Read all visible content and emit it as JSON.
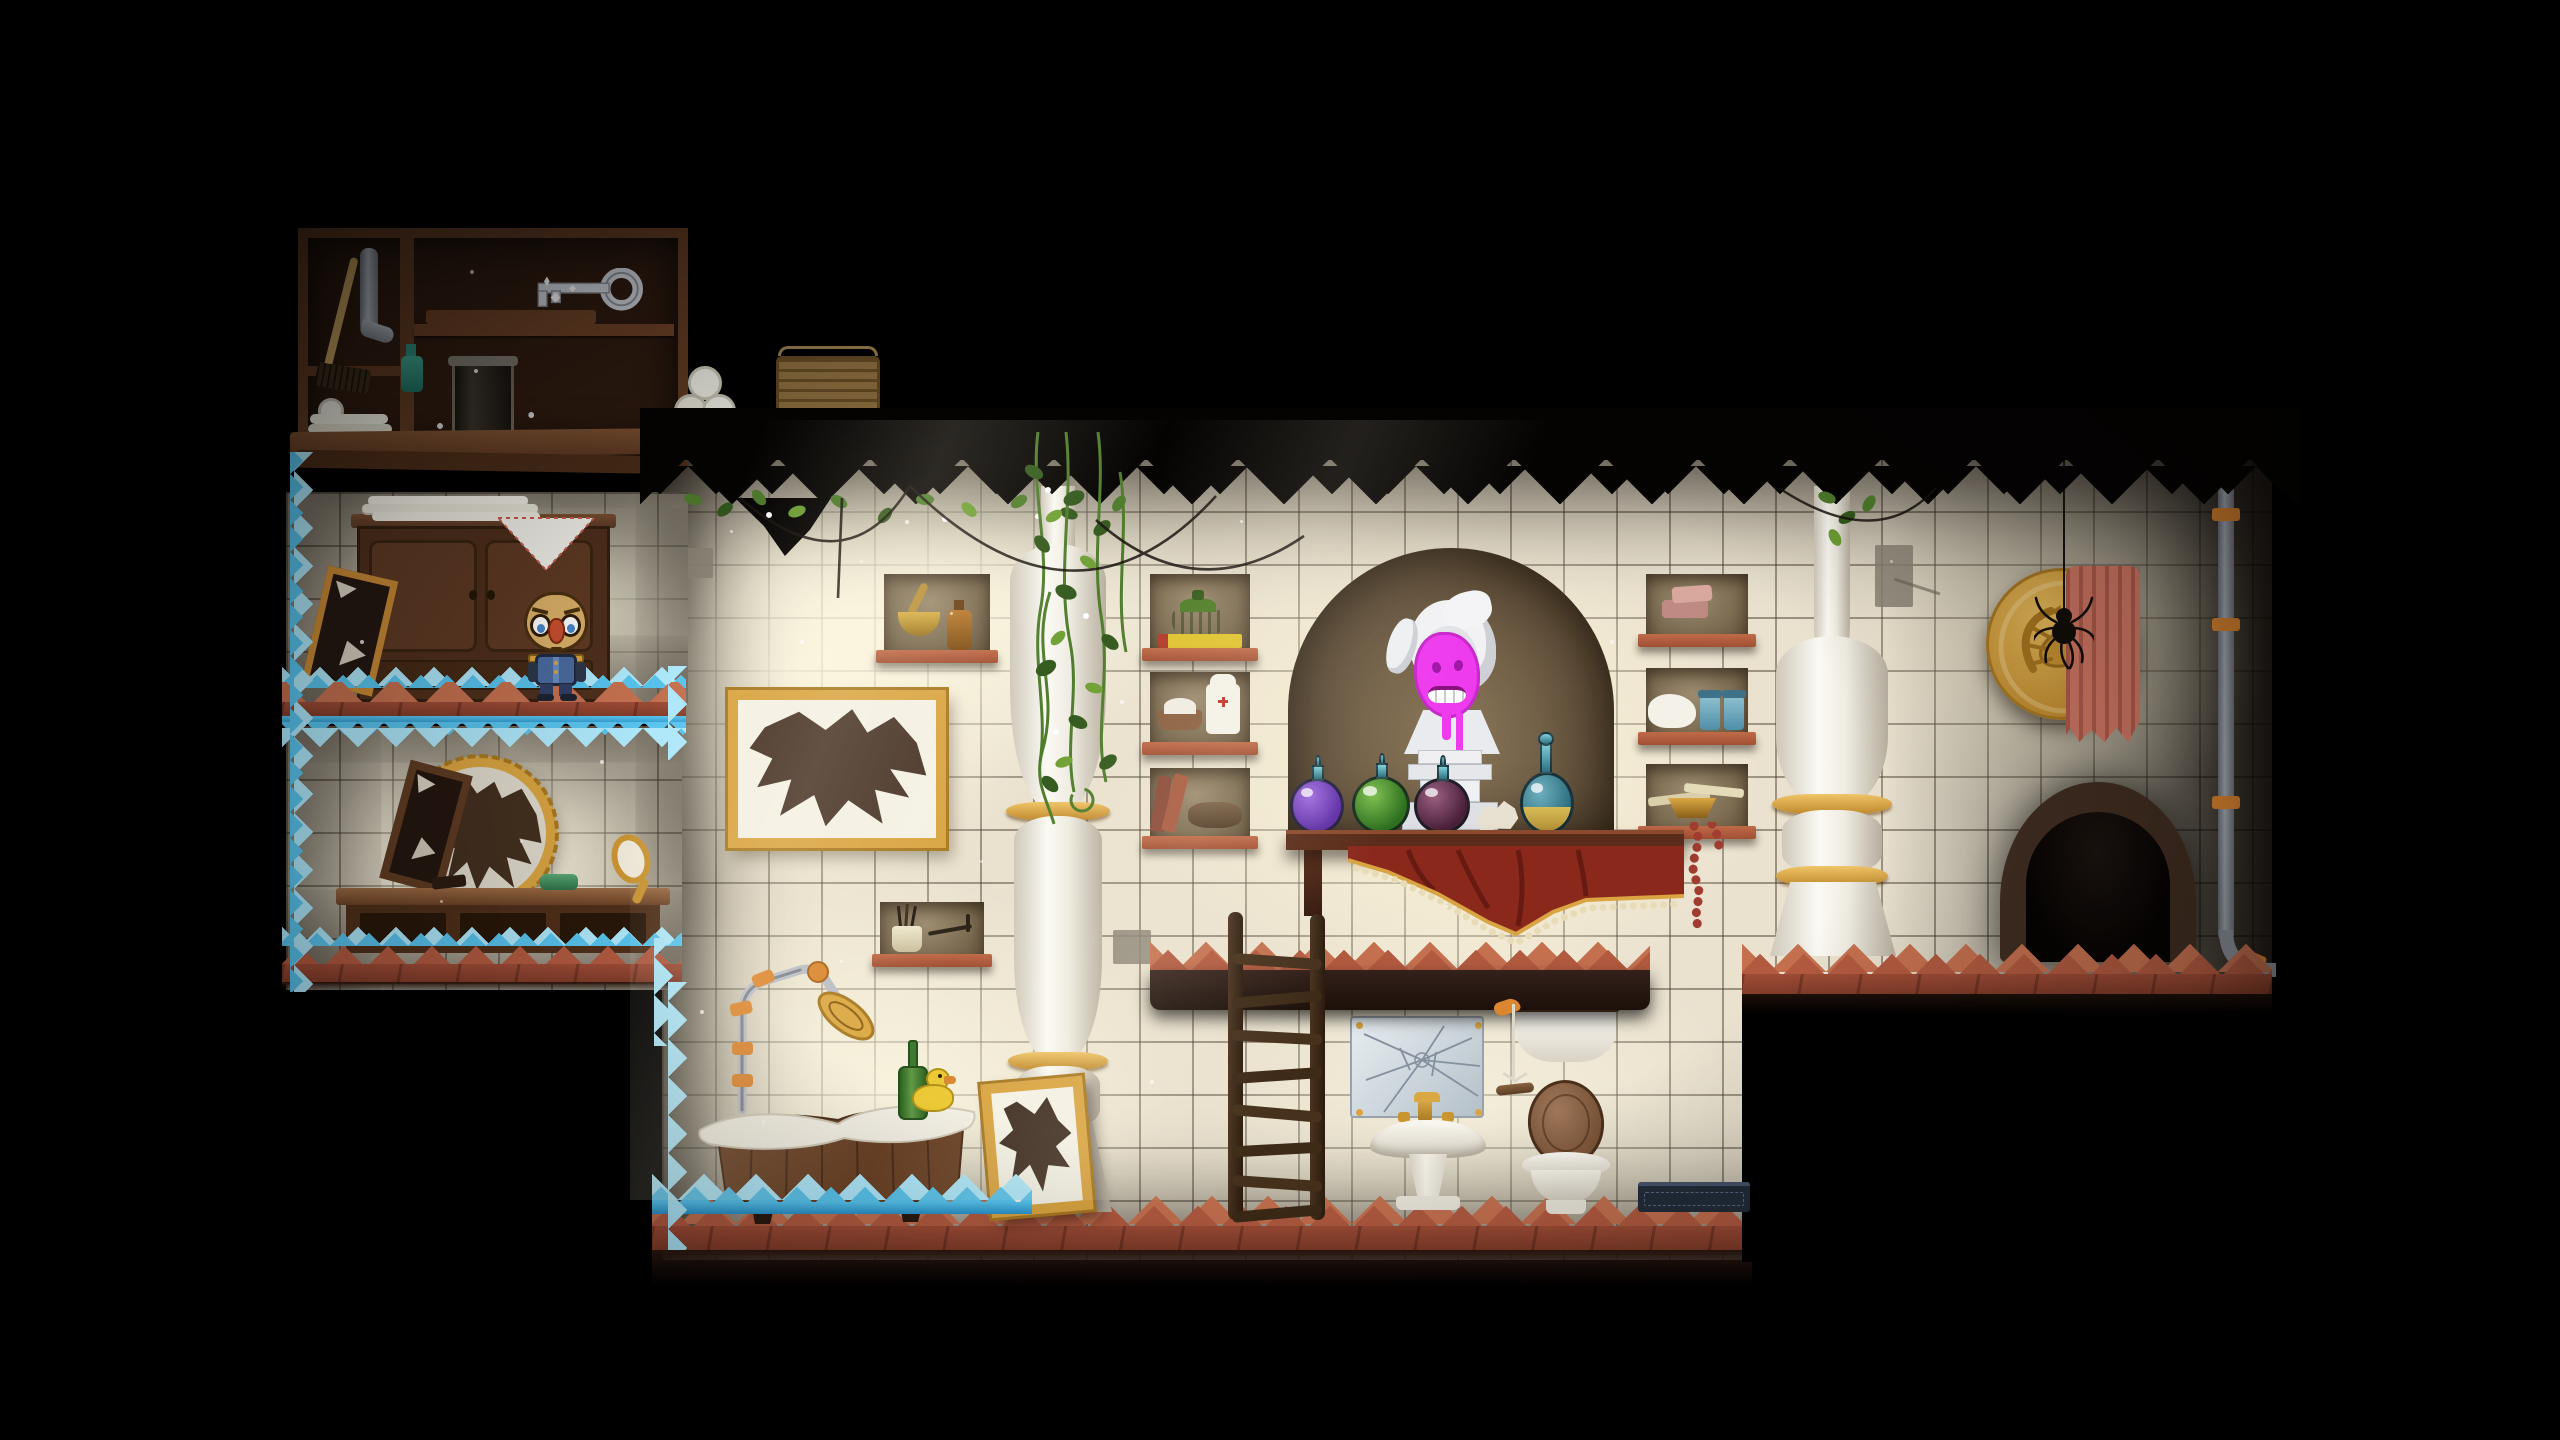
{
  "scene": {
    "view": "dark 2D puzzle-platformer level: lit, tiled bathroom chambers surrounded by blackness",
    "background_color": "#000000"
  },
  "palette": {
    "tile": "#eae2cf",
    "tile-dark": "#8a8274",
    "brick": "#b25a40",
    "brick-dark": "#7e3a28",
    "wood": "#5a3a24",
    "wood-dark": "#332012",
    "wood-light": "#7a4f32",
    "crystal": "#58c4ee",
    "crystal-light": "#aee8fb",
    "crystal-deep": "#2a93c9",
    "gold": "#d9a441",
    "gold-dark": "#a87820",
    "porcelain": "#f1ede2",
    "alcove": "#6b5942",
    "paint-pink": "#ee3bee",
    "curtain-red": "#8a281c",
    "towel-salmon": "#cf7663",
    "vine": "#4f7d2c",
    "metal": "#b9bec6",
    "pipe-orange": "#dd8630"
  },
  "labels": {
    "cabinet": "Wooden supply cabinet",
    "key": "Silver key on cabinet shelf",
    "broom": "Broom",
    "pipe_piece": "Metal drain pipe",
    "jar": "Glass jar with cobwebs",
    "basket": "Wicker basket",
    "cabinet_towels": "Rolled and folded towels",
    "wardrobe": "Dark wooden wardrobe",
    "towel_stack": "Stack of folded white towels",
    "doily": "Lace doily with red stitching",
    "leaning_mirror": "Small broken mirror leaning on wall",
    "character": "Small character with glasses, red nose and blue buttoned coat",
    "ice_platform": "Ledge overgrown with blue crystals",
    "round_mirror": "Broken round mirror in golden frame",
    "vanity": "Wooden vanity table",
    "hand_mirror": "Golden hand mirror",
    "green_soap": "Green soap",
    "wall_frame": "Broken picture frame on tiled wall",
    "lean_frame": "Broken picture leaning against column",
    "niche_mortar": "Wall niche with mortar, pestle and amber bottle",
    "niche_cup": "Wall niche with cup, brushes and razor",
    "column_left": "White carved baluster column",
    "column_right": "White carved baluster column",
    "vines": "Ivy vines hanging from the ceiling",
    "webs": "Drooping cobweb strands",
    "alcove": "Arched wall alcove",
    "bust": "White marble bust defaced with pink paint",
    "potion_purple": "Round purple potion bottle",
    "potion_green": "Round green potion bottle",
    "potion_maroon": "Round dark-red potion bottle",
    "potion_gold": "Teal bottle with golden liquid",
    "paper_ball": "Crumpled paper",
    "bust_shelf": "Dark wooden shelf under alcove",
    "curtain": "Red cloth with golden trim and beaded fringe",
    "niche_basket_green": "Niche with lidded green basket and yellow book",
    "niche_first_aid": "Niche with red-cross bottle and powder dish",
    "niche_books": "Niche with leaning books and oval box",
    "niche_soap": "Niche with pink soap bars",
    "niche_towel_jars": "Niche with white towel and blue jars",
    "niche_papers": "Niche with papers, golden bowl and bead necklace",
    "mid_platform": "Tiled stone ledge",
    "ladder": "Crooked wooden ladder",
    "cracked_panel": "Cracked mirror panel with golden screws",
    "sink": "White pedestal sink with golden faucet",
    "cistern": "Wall-mounted cistern with wooden lid",
    "pull_cord": "Flush pull cord with wooden handle",
    "toilet": "Toilet with raised wooden seat lid",
    "doormat": "Dark doormat",
    "bathtub": "Wooden bathtub with white rim",
    "shower": "Jointed shower arm with golden head",
    "green_bottle": "Green glass bottle",
    "duck": "Yellow rubber duck",
    "medallion": "Golden scorpion medallion",
    "spider": "Spider hanging from a thread",
    "salmon_towel": "Salmon towel hung over the medallion",
    "wall_pipe": "Grey wall pipe with orange clamps",
    "doorway": "Dark arched doorway",
    "floor": "Terracotta tiled floor"
  }
}
